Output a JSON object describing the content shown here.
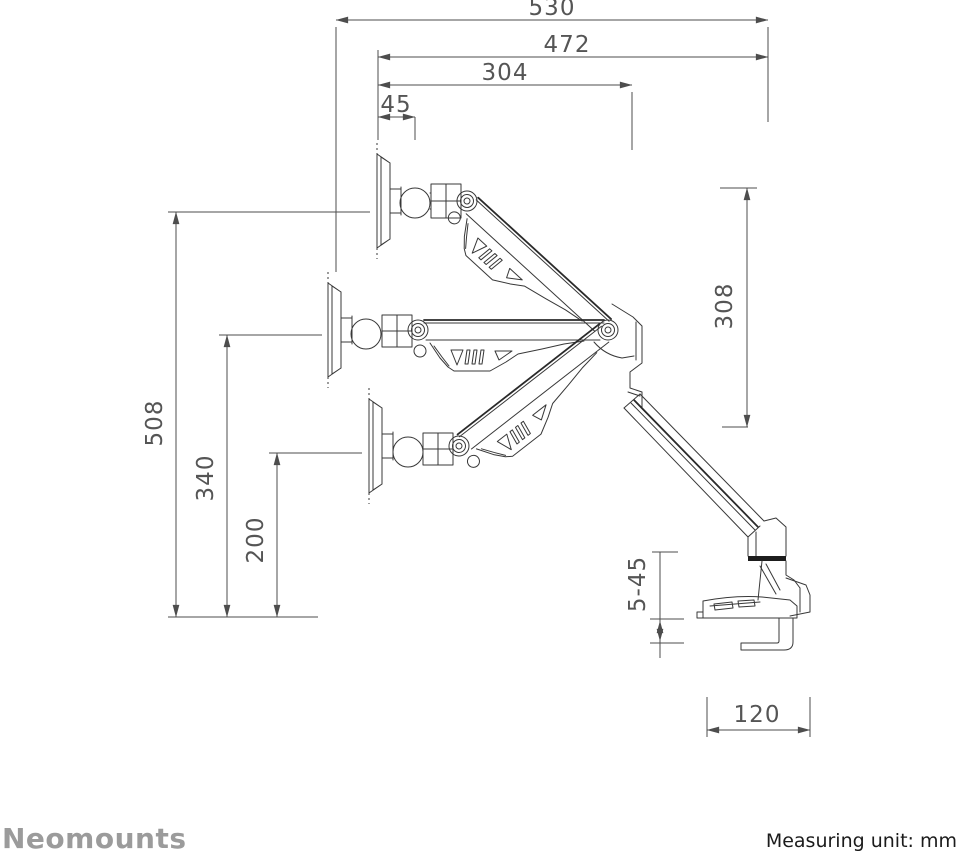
{
  "title": "Monitor arm dimensional drawing",
  "dimensions": {
    "d530": "530",
    "d472": "472",
    "d304": "304",
    "d45": "45",
    "d508": "508",
    "d340": "340",
    "d200": "200",
    "d308": "308",
    "d5_45": "5-45",
    "d120": "120"
  },
  "footer": {
    "brand": "Neomounts",
    "measuring_unit": "Measuring unit: mm"
  },
  "colors": {
    "drawing_line": "#383838",
    "dimension_line": "#4d4d4d",
    "dimension_text": "#555555",
    "brand_gray": "#9b9b9b",
    "unit_text": "#1b1b1b",
    "clamp_band": "#1d1d1d",
    "background": "#ffffff"
  }
}
